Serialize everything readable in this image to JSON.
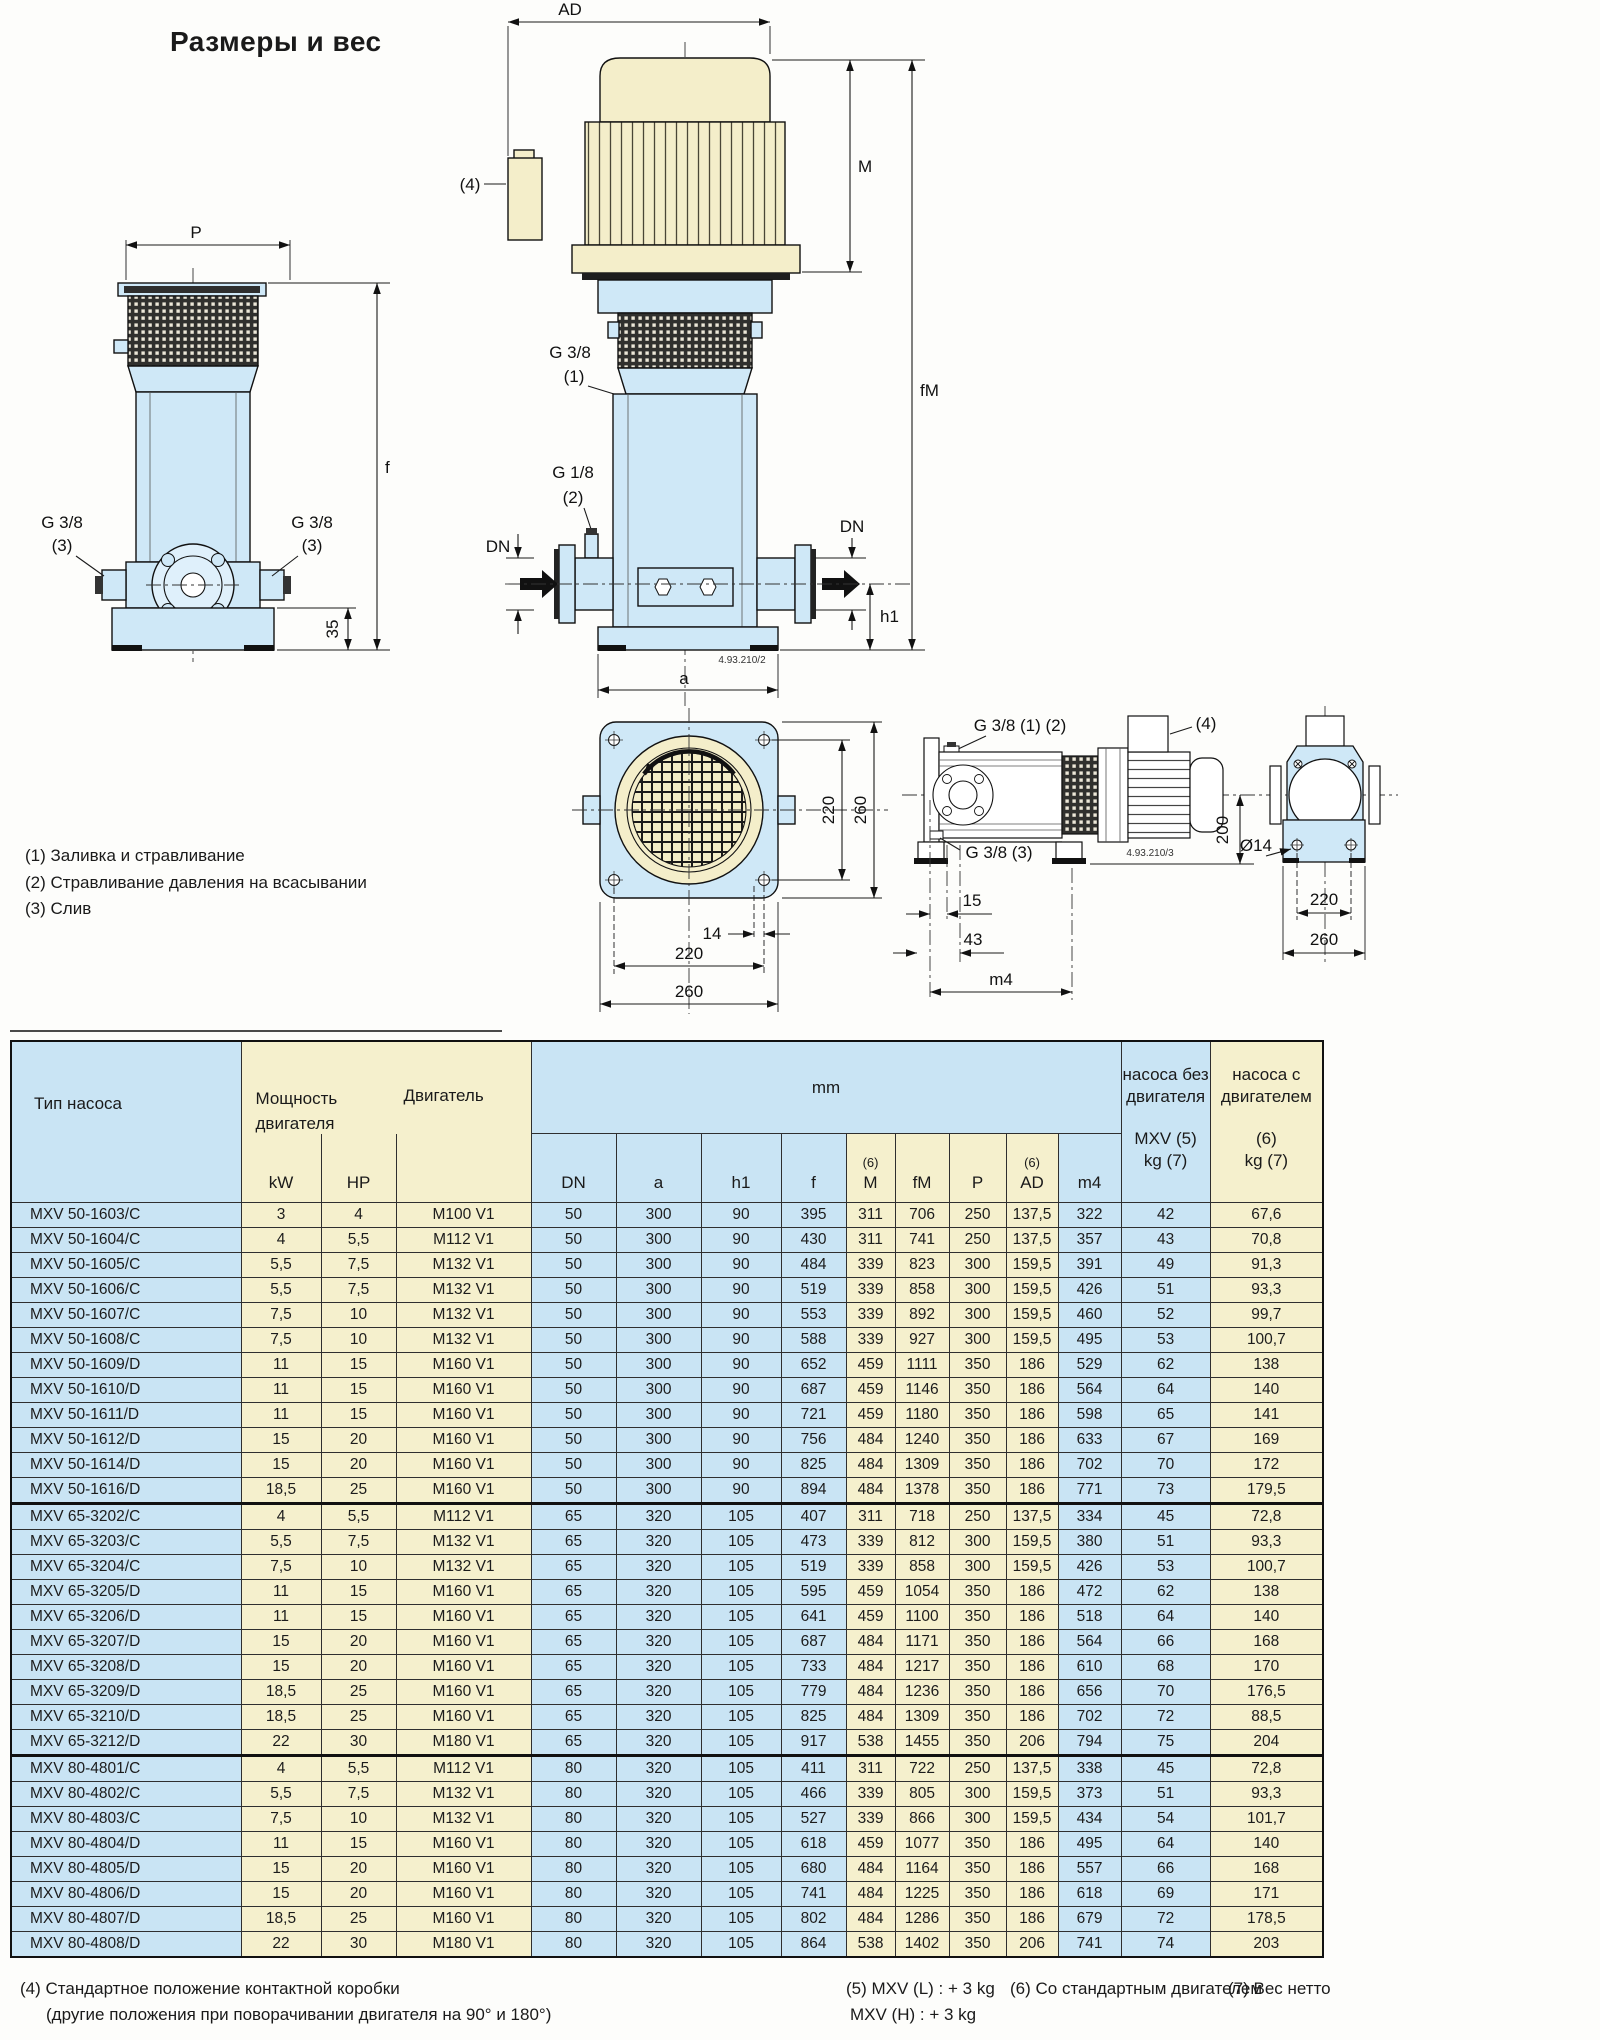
{
  "title": "Размеры и вес",
  "drawing_notes": [
    "(1) Заливка и стравливание",
    "(2) Стравливание давления на всасывании",
    "(3) Слив"
  ],
  "dwg": {
    "P": "P",
    "f": "f",
    "AD": "AD",
    "M": "M",
    "fM": "fM",
    "DN": "DN",
    "h1": "h1",
    "a": "a",
    "m4": "m4",
    "g38": "G 3/8",
    "g18": "G 1/8",
    "n1": "(1)",
    "n2": "(2)",
    "n3": "(3)",
    "n4": "(4)",
    "g38_12": "G 3/8 (1) (2)",
    "g38_3": "G 3/8 (3)",
    "code_front": "4.93.210/2",
    "code_side": "4.93.210/3",
    "d14": "14",
    "d15": "15",
    "d35": "35",
    "d43": "43",
    "d200": "200",
    "d220": "220",
    "d260": "260",
    "diam14": "Ø14"
  },
  "table": {
    "headers": {
      "type": "Тип насоса",
      "power1": "Мощность",
      "power2": "двигателя",
      "motor": "Двигатель",
      "kw": "kW",
      "hp": "HP",
      "mm": "mm",
      "dn": "DN",
      "a": "a",
      "h1": "h1",
      "f": "f",
      "m": "M",
      "fm": "fM",
      "p": "P",
      "ad": "AD",
      "m4": "m4",
      "n6": "(6)",
      "w1a": "насоса без",
      "w1b": "двигателя",
      "w1c": "MXV (5)",
      "w1d": "kg (7)",
      "w2a": "насоса с",
      "w2b": "двигателем",
      "w2c": "(6)",
      "w2d": "kg (7)"
    },
    "groups": [
      {
        "rows": [
          [
            "MXV 50-1603/C",
            "3",
            "4",
            "M100 V1",
            "50",
            "300",
            "90",
            "395",
            "311",
            "706",
            "250",
            "137,5",
            "322",
            "42",
            "67,6"
          ],
          [
            "MXV 50-1604/C",
            "4",
            "5,5",
            "M112 V1",
            "50",
            "300",
            "90",
            "430",
            "311",
            "741",
            "250",
            "137,5",
            "357",
            "43",
            "70,8"
          ],
          [
            "MXV 50-1605/C",
            "5,5",
            "7,5",
            "M132 V1",
            "50",
            "300",
            "90",
            "484",
            "339",
            "823",
            "300",
            "159,5",
            "391",
            "49",
            "91,3"
          ],
          [
            "MXV 50-1606/C",
            "5,5",
            "7,5",
            "M132 V1",
            "50",
            "300",
            "90",
            "519",
            "339",
            "858",
            "300",
            "159,5",
            "426",
            "51",
            "93,3"
          ],
          [
            "MXV 50-1607/C",
            "7,5",
            "10",
            "M132 V1",
            "50",
            "300",
            "90",
            "553",
            "339",
            "892",
            "300",
            "159,5",
            "460",
            "52",
            "99,7"
          ],
          [
            "MXV 50-1608/C",
            "7,5",
            "10",
            "M132 V1",
            "50",
            "300",
            "90",
            "588",
            "339",
            "927",
            "300",
            "159,5",
            "495",
            "53",
            "100,7"
          ],
          [
            "MXV 50-1609/D",
            "11",
            "15",
            "M160 V1",
            "50",
            "300",
            "90",
            "652",
            "459",
            "1111",
            "350",
            "186",
            "529",
            "62",
            "138"
          ],
          [
            "MXV 50-1610/D",
            "11",
            "15",
            "M160 V1",
            "50",
            "300",
            "90",
            "687",
            "459",
            "1146",
            "350",
            "186",
            "564",
            "64",
            "140"
          ],
          [
            "MXV 50-1611/D",
            "11",
            "15",
            "M160 V1",
            "50",
            "300",
            "90",
            "721",
            "459",
            "1180",
            "350",
            "186",
            "598",
            "65",
            "141"
          ],
          [
            "MXV 50-1612/D",
            "15",
            "20",
            "M160 V1",
            "50",
            "300",
            "90",
            "756",
            "484",
            "1240",
            "350",
            "186",
            "633",
            "67",
            "169"
          ],
          [
            "MXV 50-1614/D",
            "15",
            "20",
            "M160 V1",
            "50",
            "300",
            "90",
            "825",
            "484",
            "1309",
            "350",
            "186",
            "702",
            "70",
            "172"
          ],
          [
            "MXV 50-1616/D",
            "18,5",
            "25",
            "M160 V1",
            "50",
            "300",
            "90",
            "894",
            "484",
            "1378",
            "350",
            "186",
            "771",
            "73",
            "179,5"
          ]
        ]
      },
      {
        "rows": [
          [
            "MXV 65-3202/C",
            "4",
            "5,5",
            "M112 V1",
            "65",
            "320",
            "105",
            "407",
            "311",
            "718",
            "250",
            "137,5",
            "334",
            "45",
            "72,8"
          ],
          [
            "MXV 65-3203/C",
            "5,5",
            "7,5",
            "M132 V1",
            "65",
            "320",
            "105",
            "473",
            "339",
            "812",
            "300",
            "159,5",
            "380",
            "51",
            "93,3"
          ],
          [
            "MXV 65-3204/C",
            "7,5",
            "10",
            "M132 V1",
            "65",
            "320",
            "105",
            "519",
            "339",
            "858",
            "300",
            "159,5",
            "426",
            "53",
            "100,7"
          ],
          [
            "MXV 65-3205/D",
            "11",
            "15",
            "M160 V1",
            "65",
            "320",
            "105",
            "595",
            "459",
            "1054",
            "350",
            "186",
            "472",
            "62",
            "138"
          ],
          [
            "MXV 65-3206/D",
            "11",
            "15",
            "M160 V1",
            "65",
            "320",
            "105",
            "641",
            "459",
            "1100",
            "350",
            "186",
            "518",
            "64",
            "140"
          ],
          [
            "MXV 65-3207/D",
            "15",
            "20",
            "M160 V1",
            "65",
            "320",
            "105",
            "687",
            "484",
            "1171",
            "350",
            "186",
            "564",
            "66",
            "168"
          ],
          [
            "MXV 65-3208/D",
            "15",
            "20",
            "M160 V1",
            "65",
            "320",
            "105",
            "733",
            "484",
            "1217",
            "350",
            "186",
            "610",
            "68",
            "170"
          ],
          [
            "MXV 65-3209/D",
            "18,5",
            "25",
            "M160 V1",
            "65",
            "320",
            "105",
            "779",
            "484",
            "1236",
            "350",
            "186",
            "656",
            "70",
            "176,5"
          ],
          [
            "MXV 65-3210/D",
            "18,5",
            "25",
            "M160 V1",
            "65",
            "320",
            "105",
            "825",
            "484",
            "1309",
            "350",
            "186",
            "702",
            "72",
            "88,5"
          ],
          [
            "MXV 65-3212/D",
            "22",
            "30",
            "M180 V1",
            "65",
            "320",
            "105",
            "917",
            "538",
            "1455",
            "350",
            "206",
            "794",
            "75",
            "204"
          ]
        ]
      },
      {
        "rows": [
          [
            "MXV 80-4801/C",
            "4",
            "5,5",
            "M112 V1",
            "80",
            "320",
            "105",
            "411",
            "311",
            "722",
            "250",
            "137,5",
            "338",
            "45",
            "72,8"
          ],
          [
            "MXV 80-4802/C",
            "5,5",
            "7,5",
            "M132 V1",
            "80",
            "320",
            "105",
            "466",
            "339",
            "805",
            "300",
            "159,5",
            "373",
            "51",
            "93,3"
          ],
          [
            "MXV 80-4803/C",
            "7,5",
            "10",
            "M132 V1",
            "80",
            "320",
            "105",
            "527",
            "339",
            "866",
            "300",
            "159,5",
            "434",
            "54",
            "101,7"
          ],
          [
            "MXV 80-4804/D",
            "11",
            "15",
            "M160 V1",
            "80",
            "320",
            "105",
            "618",
            "459",
            "1077",
            "350",
            "186",
            "495",
            "64",
            "140"
          ],
          [
            "MXV 80-4805/D",
            "15",
            "20",
            "M160 V1",
            "80",
            "320",
            "105",
            "680",
            "484",
            "1164",
            "350",
            "186",
            "557",
            "66",
            "168"
          ],
          [
            "MXV 80-4806/D",
            "15",
            "20",
            "M160 V1",
            "80",
            "320",
            "105",
            "741",
            "484",
            "1225",
            "350",
            "186",
            "618",
            "69",
            "171"
          ],
          [
            "MXV 80-4807/D",
            "18,5",
            "25",
            "M160 V1",
            "80",
            "320",
            "105",
            "802",
            "484",
            "1286",
            "350",
            "186",
            "679",
            "72",
            "178,5"
          ],
          [
            "MXV 80-4808/D",
            "22",
            "30",
            "M180 V1",
            "80",
            "320",
            "105",
            "864",
            "538",
            "1402",
            "350",
            "206",
            "741",
            "74",
            "203"
          ]
        ]
      }
    ]
  },
  "footnotes": {
    "n4_l1": "(4) Стандартное положение контактной коробки",
    "n4_l2": "(другие положения при поворачивании двигателя на 90° и 180°)",
    "n5_l1": "(5) MXV (L) : + 3 kg",
    "n5_l2": "MXV (H) : + 3 kg",
    "n6": "(6) Со стандартным двигателем",
    "n7": "(7) Вес нетто"
  }
}
